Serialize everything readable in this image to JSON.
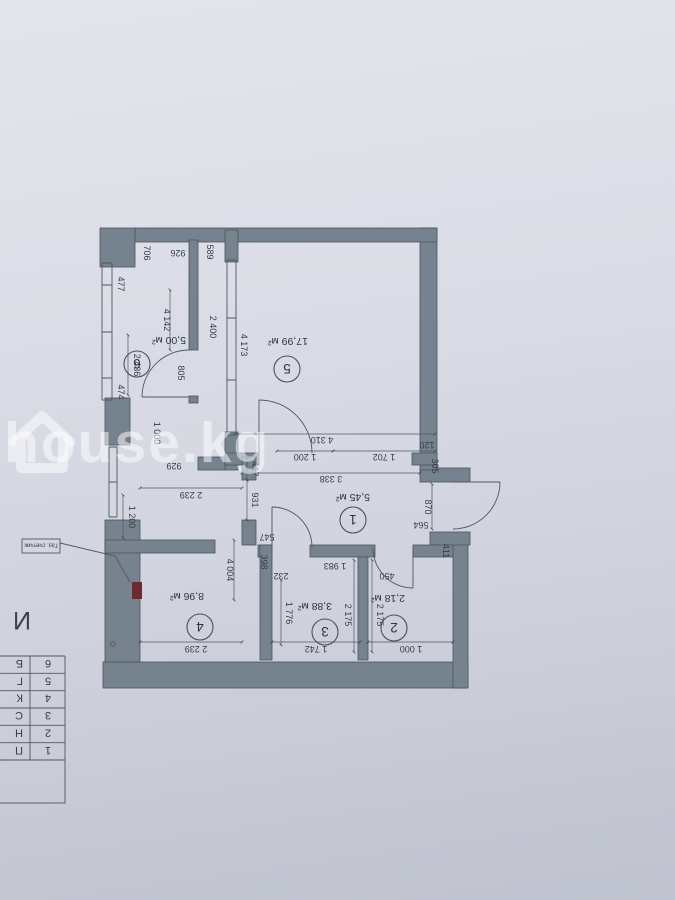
{
  "watermark": {
    "text": "house.kg",
    "icon": "house-outline-icon"
  },
  "plan": {
    "rooms": [
      {
        "num": "1",
        "area": "5,45 м²"
      },
      {
        "num": "2",
        "area": "2,18 м²"
      },
      {
        "num": "3",
        "area": "3,88 м²"
      },
      {
        "num": "4",
        "area": "8,96 м²"
      },
      {
        "num": "5",
        "area": "17,99 м²"
      },
      {
        "num": "6",
        "area": "5,00 м²"
      }
    ],
    "annotations": {
      "gas_meter": "Газ. счетчик",
      "cut_letter": "И"
    },
    "legend": {
      "rows": [
        {
          "num": "1",
          "text": "П"
        },
        {
          "num": "2",
          "text": "Н"
        },
        {
          "num": "3",
          "text": "С"
        },
        {
          "num": "4",
          "text": "К"
        },
        {
          "num": "5",
          "text": "Г"
        },
        {
          "num": "6",
          "text": "Б"
        }
      ]
    },
    "dimensions": {
      "d926": "926",
      "d706": "706",
      "d589": "589",
      "d477": "477",
      "d474": "474",
      "d2436": "2 436",
      "d4142": "4 142",
      "d2400": "2 400",
      "d4173": "4 173",
      "d805": "805",
      "d4310": "4 310",
      "d1200b": "1 200",
      "d1702": "1 702",
      "d120": "120",
      "d305": "305",
      "d3338": "3 338",
      "d870": "870",
      "d564": "564",
      "d411": "411",
      "d417": "417",
      "d931": "931",
      "d4004": "4 004",
      "d547": "547",
      "d398": "398",
      "d232": "232",
      "d1983": "1 983",
      "d450": "450",
      "d1776": "1 776",
      "d2175a": "2 175",
      "d2175b": "2 175",
      "d2239a": "2 239",
      "d1200a": "1 200",
      "d929": "929",
      "d1000a": "1 000",
      "d2239b": "2 239",
      "d1742": "1 742",
      "d1000b": "1 000"
    },
    "colors": {
      "wall": "#76838e",
      "line": "#49535d",
      "gas_meter_mark": "#6b2b31",
      "paper": "#d6d8e2"
    }
  }
}
